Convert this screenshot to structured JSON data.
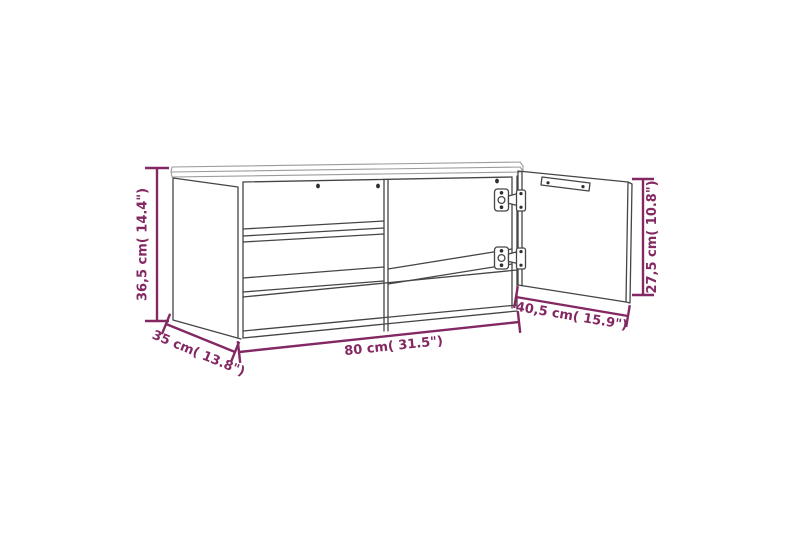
{
  "diagram": {
    "background_color": "#ffffff",
    "outline_color": "#454545",
    "accent_color": "#832862",
    "subject": "tv-stand-line-drawing-with-open-door",
    "dimensions": {
      "height": {
        "label": "36,5 cm( 14.4\")",
        "value_cm": "36,5",
        "value_in": "14.4"
      },
      "depth": {
        "label": "35 cm( 13.8\")",
        "value_cm": "35",
        "value_in": "13.8"
      },
      "width": {
        "label": "80 cm( 31.5\")",
        "value_cm": "80",
        "value_in": "31.5"
      },
      "door_width": {
        "label": "40,5 cm( 15.9\")",
        "value_cm": "40,5",
        "value_in": "15.9"
      },
      "door_height": {
        "label": "27,5 cm( 10.8\")",
        "value_cm": "27,5",
        "value_in": "10.8"
      }
    }
  }
}
